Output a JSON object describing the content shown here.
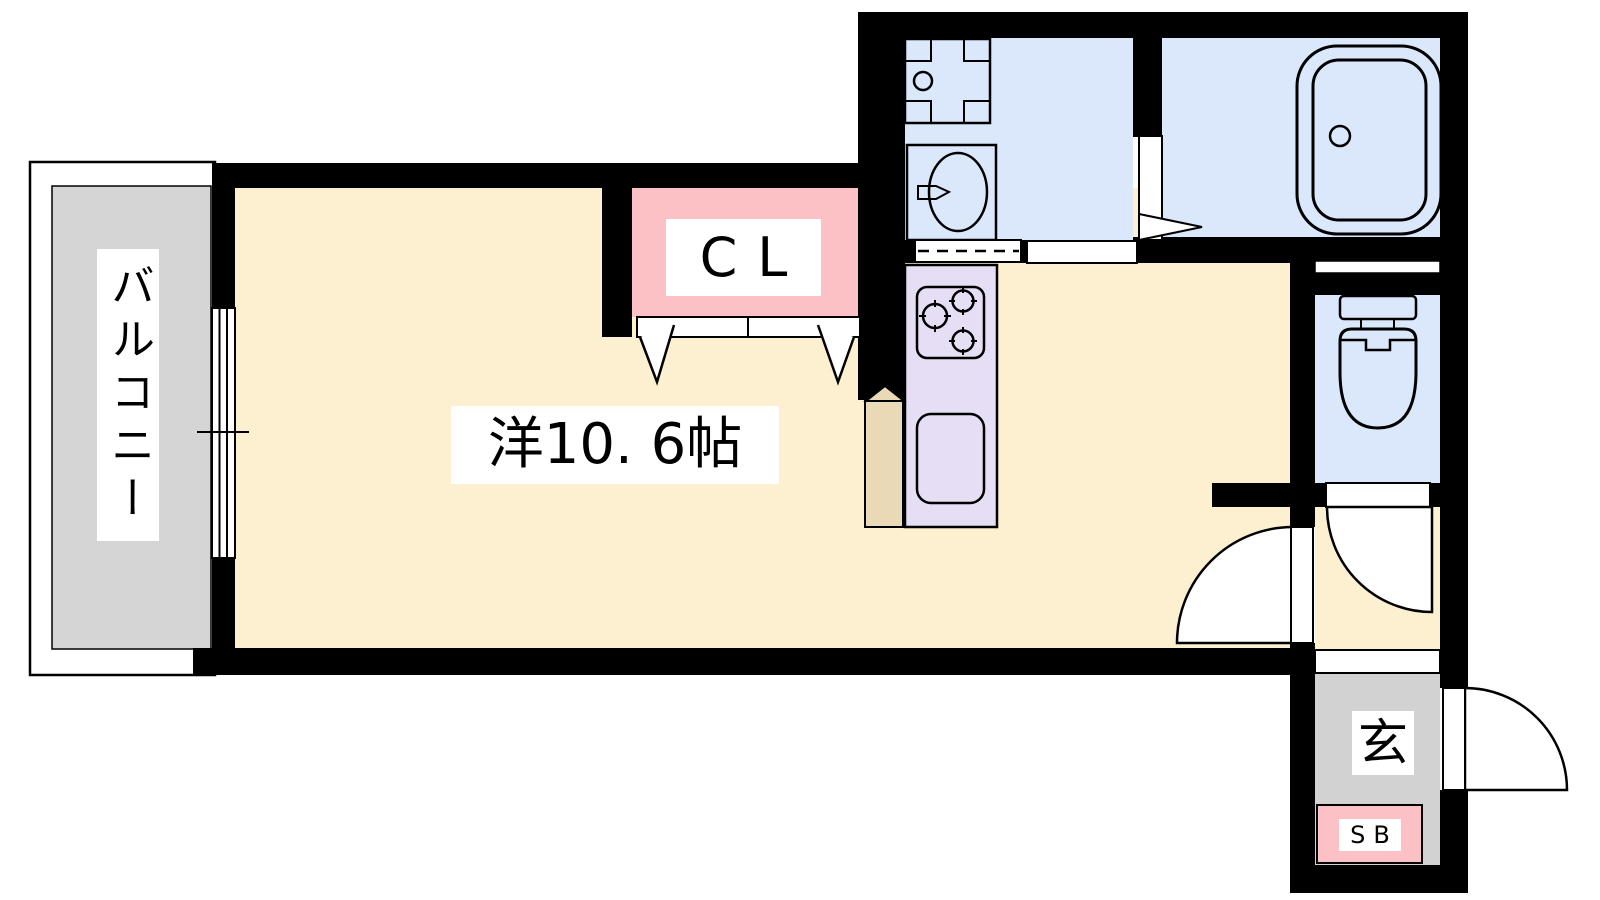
{
  "floorplan": {
    "rooms": {
      "balcony": {
        "label": "バルコニー"
      },
      "main_room": {
        "label": "洋10. 6帖"
      },
      "closet": {
        "label": "CL"
      },
      "entrance": {
        "label": "玄"
      },
      "shoe_box": {
        "label": "SB"
      }
    },
    "colors": {
      "wall": "#000000",
      "line": "#000000",
      "floor_cream": "#fdf0d0",
      "wet_area_blue": "#dbe8fb",
      "closet_pink": "#fbc1c5",
      "kitchen_purple": "#e6def4",
      "counter_tan": "#e9d9b6",
      "balcony_gray": "#d5d5d5",
      "entrance_gray": "#d2d2d2",
      "label_bg": "#ffffff"
    }
  }
}
